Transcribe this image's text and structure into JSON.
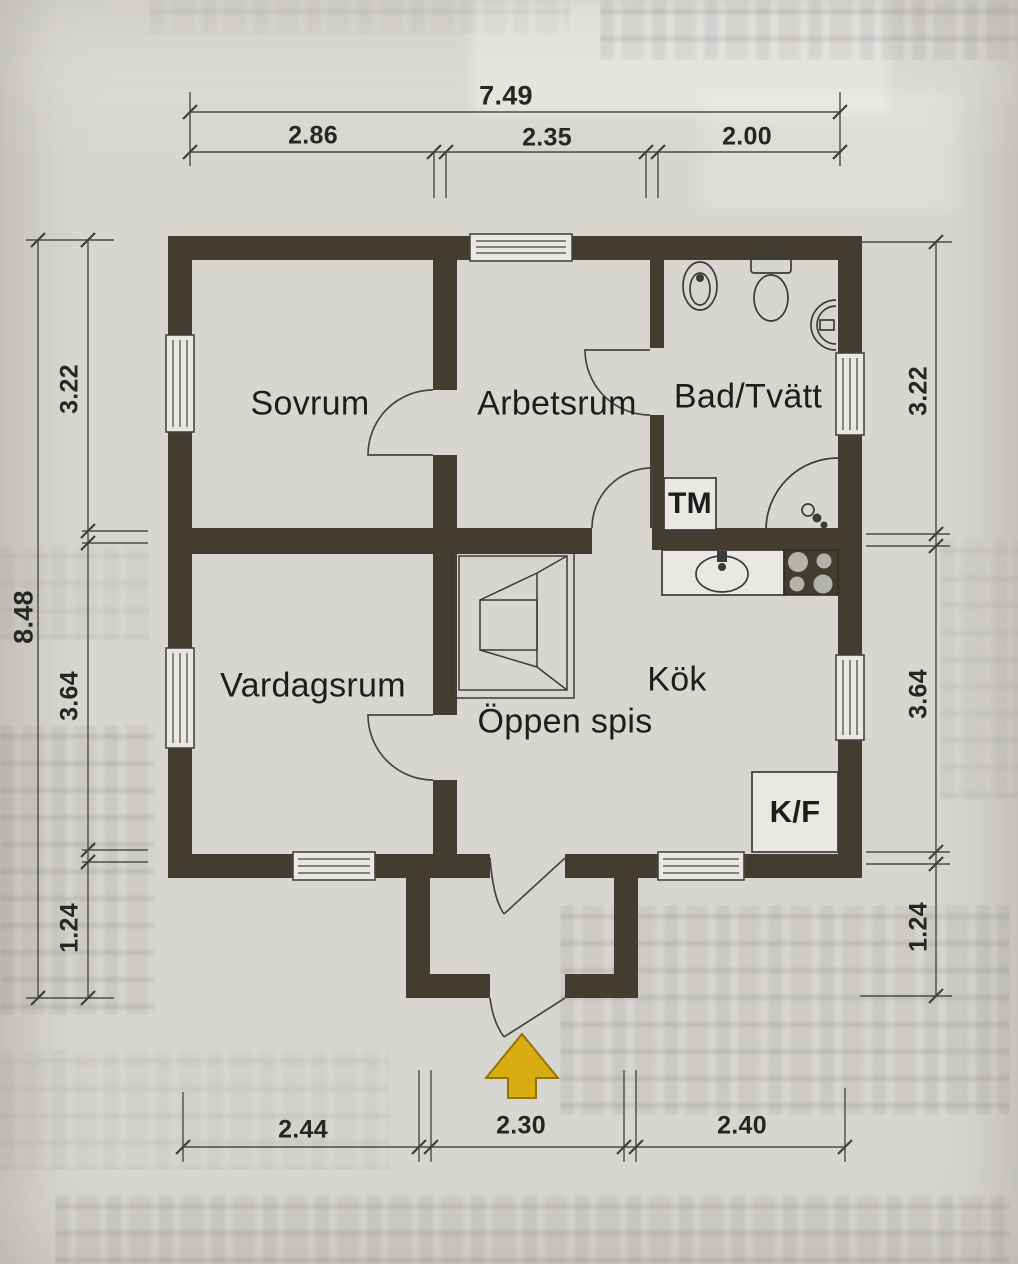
{
  "document": {
    "type": "scanned floor plan",
    "language": "Swedish"
  },
  "labels": {
    "sovrum": "Sovrum",
    "arbetsrum": "Arbetsrum",
    "bad_tvatt": "Bad/Tvätt",
    "vardagsrum": "Vardagsrum",
    "kok": "Kök",
    "oppen_spis": "Öppen spis",
    "tm": "TM",
    "kf": "K/F"
  },
  "dimensions": {
    "top": {
      "total": "7.49",
      "segments": [
        "2.86",
        "2.35",
        "2.00"
      ]
    },
    "left": {
      "total": "8.48",
      "segments": [
        "3.22",
        "3.64",
        "1.24"
      ]
    },
    "right": {
      "segments": [
        "3.22",
        "3.64",
        "1.24"
      ]
    },
    "bottom": {
      "segments": [
        "2.44",
        "2.30",
        "2.40"
      ]
    }
  },
  "colors": {
    "paper": "#d8d6d1",
    "wall": "#433c30",
    "line": "#454545",
    "fix": "#eae8e3",
    "arrow": "#d9ad12",
    "arrowline": "#8f7606",
    "text": "#1d1d1d"
  }
}
